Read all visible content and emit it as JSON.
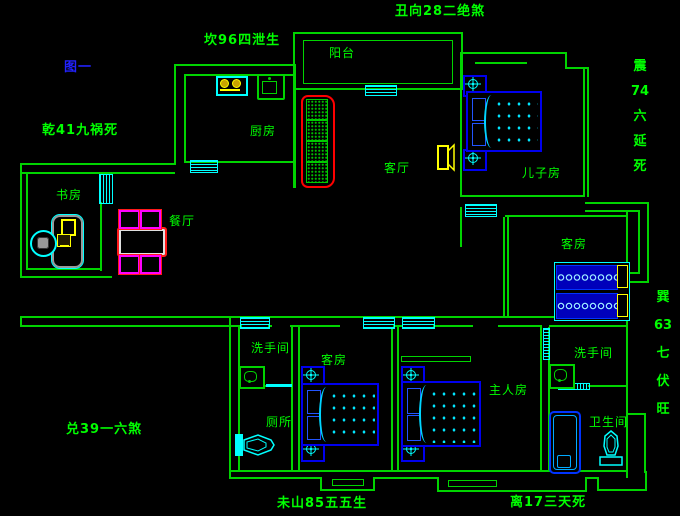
{
  "figure_title": "图一",
  "annotations": {
    "north": "丑向28二绝煞",
    "northwest": "坎96四泄生",
    "west": "乾41九祸死",
    "east_upper": [
      "震",
      "74",
      "六",
      "延",
      "死"
    ],
    "east_lower": [
      "巽",
      "63",
      "七",
      "伏",
      "旺"
    ],
    "southwest": "兑39一六煞",
    "south": "未山85五五生",
    "southeast": "离17三天死"
  },
  "rooms": {
    "balcony": "阳台",
    "kitchen": "厨房",
    "living": "客厅",
    "son_room": "儿子房",
    "study": "书房",
    "dining": "餐厅",
    "guest_right": "客房",
    "guest_mid": "客房",
    "master": "主人房",
    "bath_left": "洗手间",
    "bath_right": "洗手间",
    "toilet": "厕所",
    "bathroom": "卫生间"
  },
  "colors": {
    "background": "#000000",
    "wall": "#00d400",
    "label": "#00ff00",
    "window": "#00ffff",
    "bed": "#0000ee",
    "sofa_outline": "#ff0000",
    "chair_outline": "#ff00ff",
    "accent_yellow": "#ffff00",
    "figure_label": "#2222ff"
  }
}
